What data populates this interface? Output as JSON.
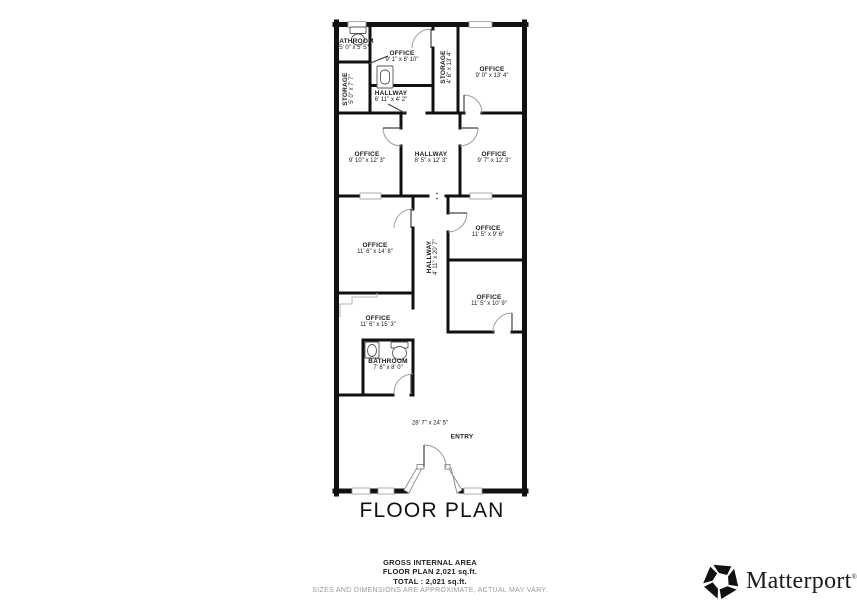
{
  "title": "FLOOR PLAN",
  "footer": {
    "area_label": "GROSS INTERNAL AREA",
    "floor_plan_area": "FLOOR PLAN 2,021 sq.ft.",
    "total_area": "TOTAL :  2,021 sq.ft.",
    "disclaimer": "SIZES AND DIMENSIONS ARE APPROXIMATE, ACTUAL MAY VARY."
  },
  "brand": {
    "name": "Matterport",
    "registered_mark": "®"
  },
  "colors": {
    "wall": "#111111",
    "thin_line": "#999999",
    "text": "#1c1c1c",
    "disclaimer_text": "#9a9a9a"
  },
  "rooms": [
    {
      "label": "BATHROOM",
      "dimensions": "5' 0\" x 5' 5\"",
      "x": 354,
      "y": 45,
      "rotate": 0
    },
    {
      "label": "OFFICE",
      "dimensions": "9' 1\" x 8' 10\"",
      "x": 402,
      "y": 57,
      "rotate": 0
    },
    {
      "label": "STORAGE",
      "dimensions": "4' 6\" x 13' 4\"",
      "x": 447,
      "y": 67,
      "rotate": -90
    },
    {
      "label": "OFFICE",
      "dimensions": "9' 0\" x 13' 4\"",
      "x": 492,
      "y": 73,
      "rotate": 0
    },
    {
      "label": "STORAGE",
      "dimensions": "5' 0\" x 7' 7\"",
      "x": 349,
      "y": 89,
      "rotate": -90
    },
    {
      "label": "HALLWAY",
      "dimensions": "6' 11\" x 4' 2\"",
      "x": 391,
      "y": 97,
      "rotate": 0
    },
    {
      "label": "OFFICE",
      "dimensions": "9' 10\" x 12' 3\"",
      "x": 367,
      "y": 158,
      "rotate": 0
    },
    {
      "label": "HALLWAY",
      "dimensions": "8' 5\" x 12' 3\"",
      "x": 431,
      "y": 158,
      "rotate": 0
    },
    {
      "label": "OFFICE",
      "dimensions": "9' 7\" x 12' 3\"",
      "x": 494,
      "y": 158,
      "rotate": 0
    },
    {
      "label": "OFFICE",
      "dimensions": "11' 6\" x 14' 8\"",
      "x": 375,
      "y": 249,
      "rotate": 0
    },
    {
      "label": "HALLWAY",
      "dimensions": "4' 11\" x 20' 7\"",
      "x": 433,
      "y": 257,
      "rotate": -90
    },
    {
      "label": "OFFICE",
      "dimensions": "11' 5\" x 9' 6\"",
      "x": 488,
      "y": 232,
      "rotate": 0
    },
    {
      "label": "OFFICE",
      "dimensions": "11' 5\" x 10' 9\"",
      "x": 489,
      "y": 301,
      "rotate": 0
    },
    {
      "label": "OFFICE",
      "dimensions": "11' 6\" x 15' 3\"",
      "x": 378,
      "y": 322,
      "rotate": 0
    },
    {
      "label": "BATHROOM",
      "dimensions": "7' 8\" x 8' 0\"",
      "x": 388,
      "y": 365,
      "rotate": 0
    },
    {
      "label": "",
      "dimensions": "28' 7\" x 24' 5\"",
      "x": 430,
      "y": 424,
      "rotate": 0
    },
    {
      "label": "ENTRY",
      "dimensions": "",
      "x": 462,
      "y": 437,
      "rotate": 0
    }
  ]
}
